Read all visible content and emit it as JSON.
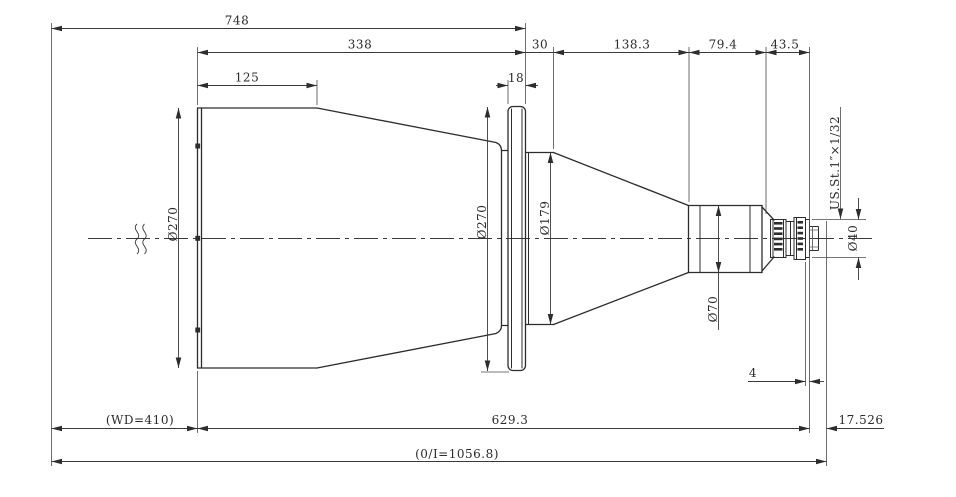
{
  "drawing": {
    "kind": "lens-outline-technical-drawing",
    "dims": {
      "overall_front": "748",
      "rear_body": "338",
      "front_barrel": "125",
      "flange_to_taper": "30",
      "taper_section": "138.3",
      "mid_barrel": "79.4",
      "mount_section": "43.5",
      "flange_thickness": "18",
      "cmount_flange": "4",
      "dia_front": "Ø270",
      "dia_flange": "Ø270",
      "dia_mid": "Ø179",
      "dia_rear": "Ø70",
      "dia_mount": "Ø40",
      "thread_spec": "US.St.1″×1/32",
      "working_distance": "(WD=410)",
      "body_to_flange_face": "629.3",
      "flange_focal_distance": "17.526",
      "object_image_distance": "(0/I=1056.8)"
    }
  }
}
